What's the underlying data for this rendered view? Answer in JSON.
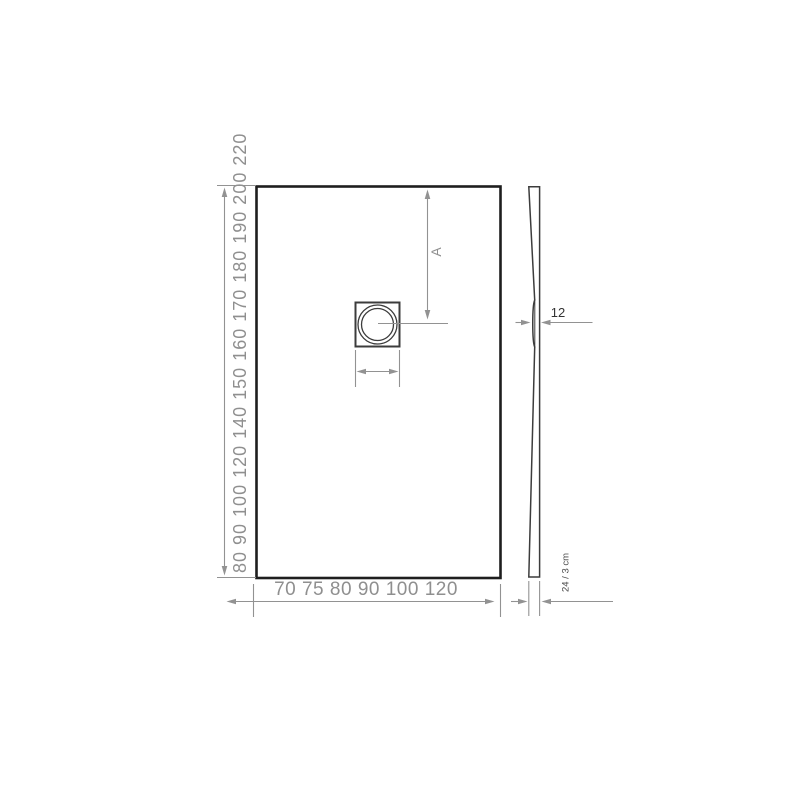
{
  "plan_view": {
    "length_scale_text": "80 90 100 120 140 150 160 170 180 190 200 220",
    "length_scale_values": [
      80,
      90,
      100,
      120,
      140,
      150,
      160,
      170,
      180,
      190,
      200,
      220
    ],
    "width_scale_text": "70 75 80 90 100 120",
    "width_scale_values": [
      70,
      75,
      80,
      90,
      100,
      120
    ],
    "drain_offset_label": "A"
  },
  "side_view": {
    "recess_thickness_label": "12",
    "height_label": "24 / 3 cm"
  },
  "colors": {
    "background": "#ffffff",
    "outline": "#1e1e1e",
    "mid": "#3c3c3c",
    "dim": "#929292",
    "text_gray": "#8f8f8f",
    "text_dark": "#333333",
    "text_dark2": "#4a4a4a"
  }
}
